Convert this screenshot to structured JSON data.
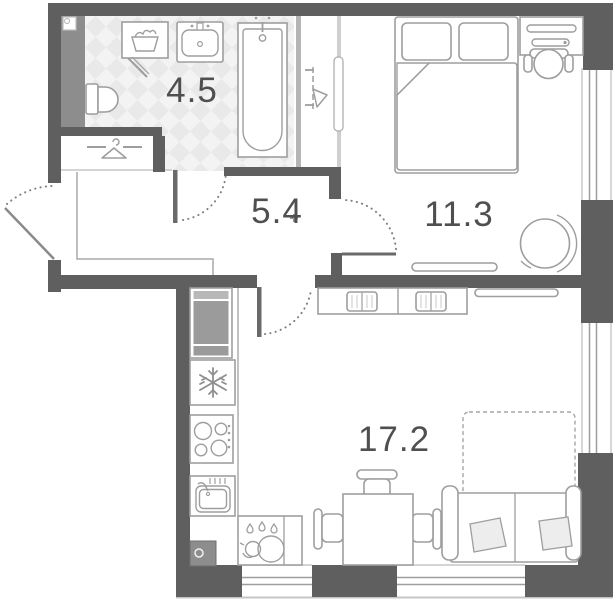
{
  "plan_title": "studio apartment floor plan",
  "rooms": {
    "bathroom": {
      "name": "bathroom",
      "area": "4.5"
    },
    "hallway": {
      "name": "hallway",
      "area": "5.4"
    },
    "bedroom": {
      "name": "bedroom",
      "area": "11.3"
    },
    "living_kitchen": {
      "name": "living-kitchen",
      "area": "17.2"
    }
  },
  "colors": {
    "wall": "#5f5f5f",
    "shaft": "#8d8d8d",
    "furniture_stroke": "#9e9e9e",
    "floor_tile": "#e9e9e9",
    "label_text": "#4f4f4f",
    "background": "#ffffff"
  },
  "fixtures": [
    "laundry-basket",
    "washbasin",
    "bathtub",
    "toilet",
    "clothes-hanger",
    "heating-riser",
    "ventilation-grille",
    "tall-cabinet",
    "refrigerator",
    "cooktop",
    "kitchen-sink",
    "kettle",
    "dining-table",
    "dining-chair",
    "double-bed",
    "pillow",
    "blanket",
    "desk",
    "desk-chair",
    "tv",
    "wardrobe",
    "armchair",
    "sofa",
    "sofa-bed",
    "window",
    "door"
  ]
}
